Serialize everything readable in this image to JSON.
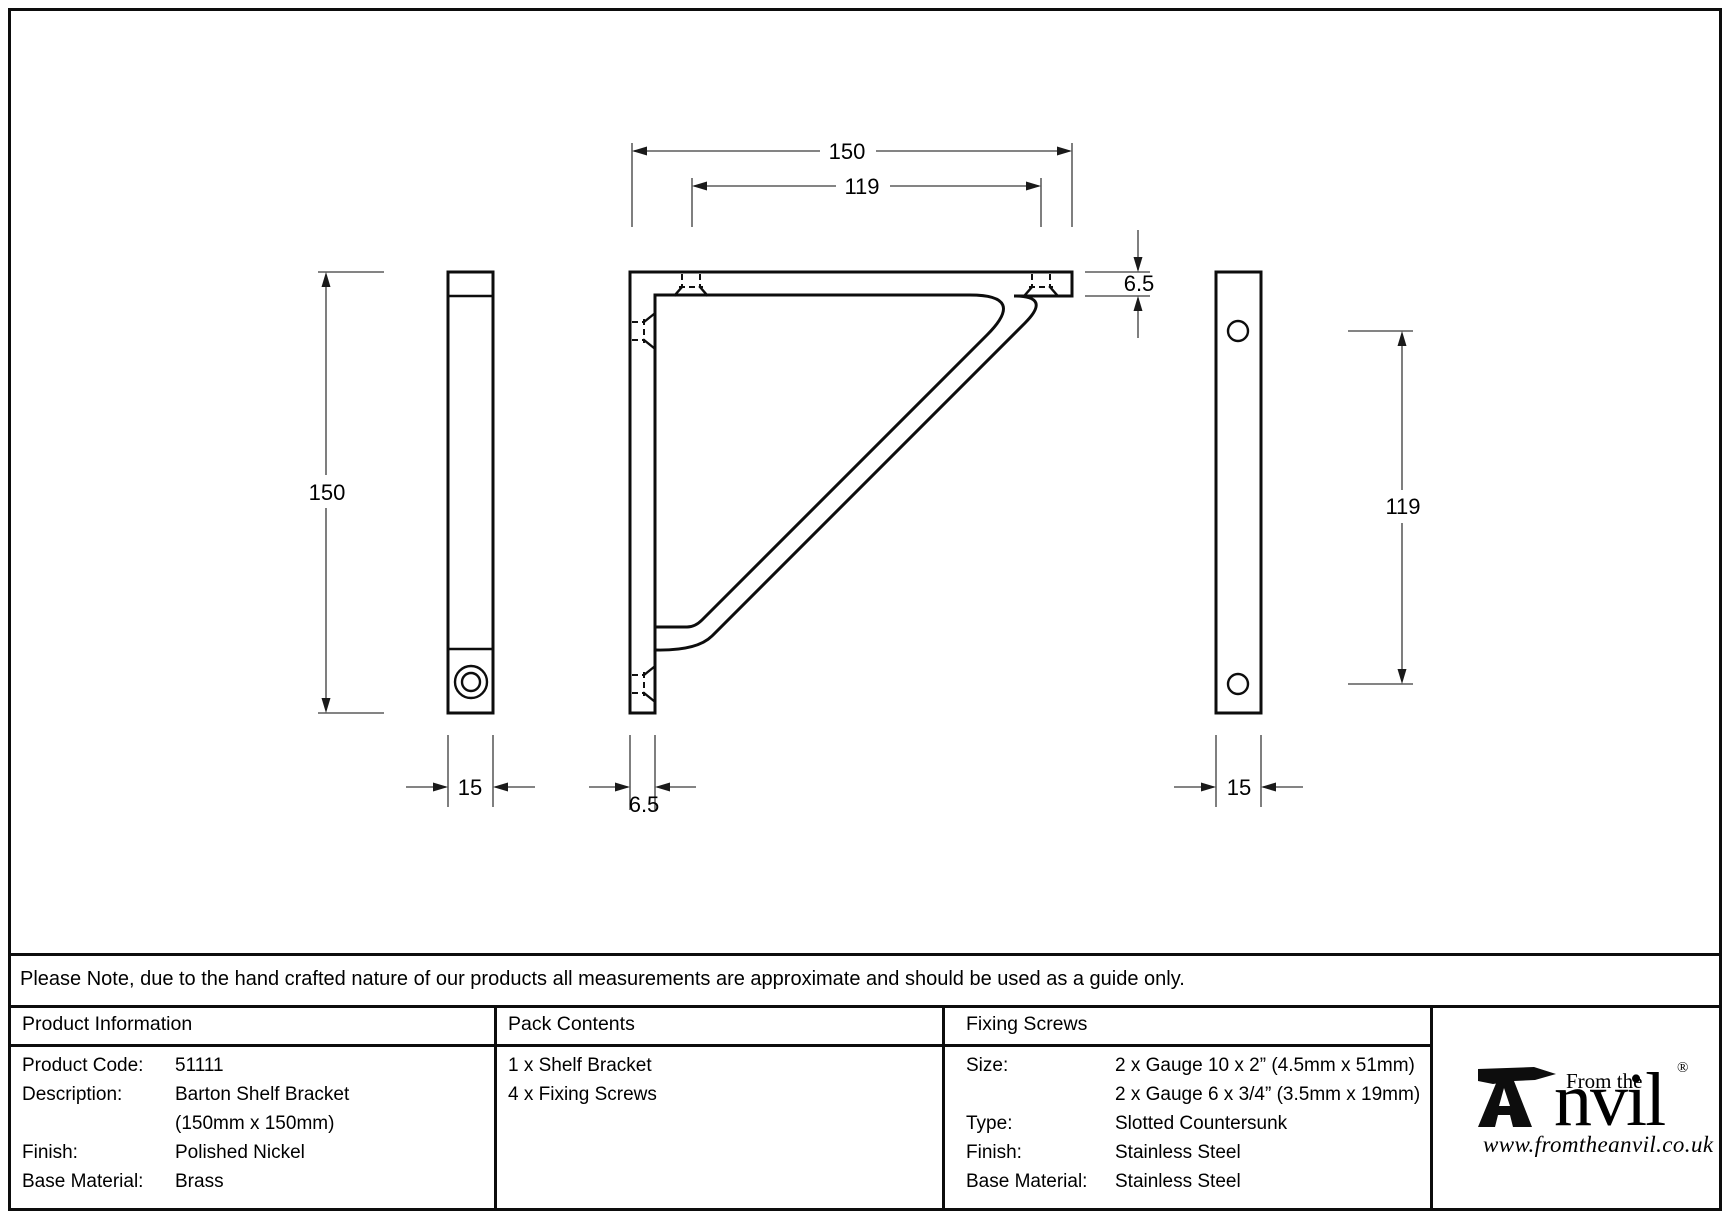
{
  "drawing": {
    "dims": {
      "front_width": "150",
      "front_hole_spacing": "119",
      "front_thickness": "6.5",
      "front_arm_thickness": "6.5",
      "side_left_height": "150",
      "side_left_width": "15",
      "side_right_hole_spacing": "119",
      "side_right_width": "15"
    }
  },
  "note": "Please Note, due to the hand crafted nature of our products all measurements are approximate and should be used as a guide only.",
  "product_information": {
    "header": "Product Information",
    "rows": [
      {
        "label": "Product Code:",
        "value": "51111"
      },
      {
        "label": "Description:",
        "value": "Barton Shelf Bracket"
      },
      {
        "label": "",
        "value": "(150mm x 150mm)"
      },
      {
        "label": "Finish:",
        "value": "Polished Nickel"
      },
      {
        "label": "Base Material:",
        "value": "Brass"
      }
    ]
  },
  "pack_contents": {
    "header": "Pack Contents",
    "items": [
      "1 x Shelf Bracket",
      "4 x Fixing Screws"
    ]
  },
  "fixing_screws": {
    "header": "Fixing Screws",
    "rows": [
      {
        "label": "Size:",
        "value": "2 x Gauge 10 x 2” (4.5mm x 51mm)"
      },
      {
        "label": "",
        "value": "2 x Gauge 6 x 3/4” (3.5mm x 19mm)"
      },
      {
        "label": "Type:",
        "value": "Slotted Countersunk"
      },
      {
        "label": "Finish:",
        "value": "Stainless Steel"
      },
      {
        "label": "Base Material:",
        "value": "Stainless Steel"
      }
    ]
  },
  "logo": {
    "tagline": "From the",
    "name": "nvil",
    "registered": "®",
    "url": "www.fromtheanvil.co.uk"
  },
  "colors": {
    "ink": "#0d0d0d",
    "paper": "#ffffff"
  }
}
